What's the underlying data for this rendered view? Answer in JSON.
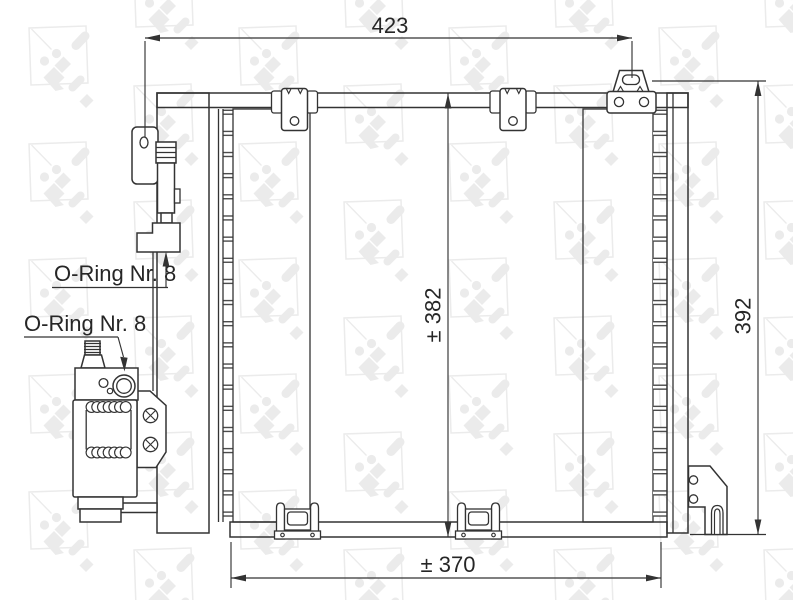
{
  "colors": {
    "background": "#ffffff",
    "line": "#333333",
    "fin": "#4a4a4a",
    "text": "#262626",
    "watermark": "#ebebeb"
  },
  "watermark": {
    "brand": "NRF"
  },
  "drawing": {
    "dim_width_top": "423",
    "dim_height_core": "± 382",
    "dim_height_total": "392",
    "dim_width_bottom": "± 370",
    "label_oring_upper": "O-Ring Nr. 8",
    "label_oring_lower": "O-Ring Nr. 8"
  }
}
